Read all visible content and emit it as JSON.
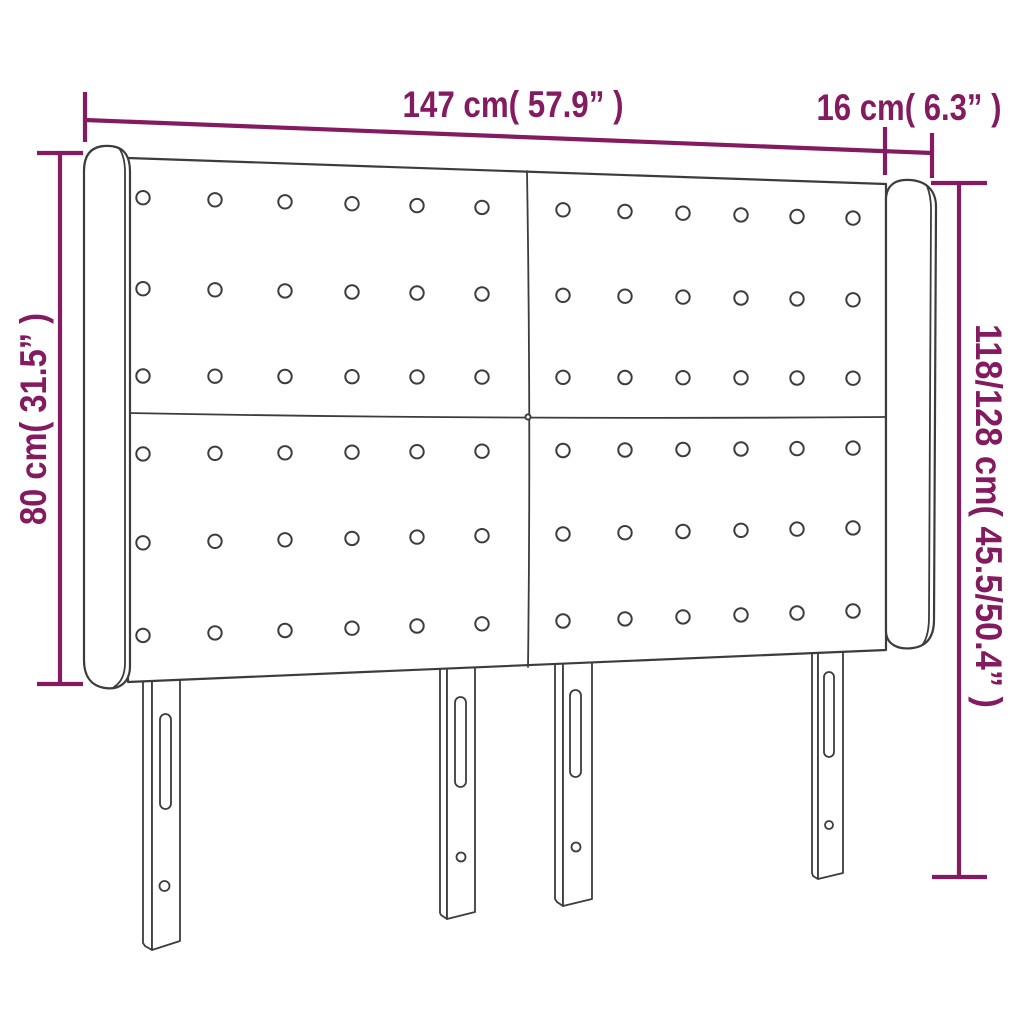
{
  "diagram": {
    "subject": "winged headboard with button tufting and four slotted legs",
    "dimensions": {
      "top_width": {
        "label": "147 cm( 57.9” )"
      },
      "ear_width": {
        "label": "16 cm( 6.3” )"
      },
      "left_height": {
        "label": "80 cm( 31.5” )"
      },
      "right_height": {
        "label": "118/128 cm( 45.5/50.4” )"
      }
    },
    "colors": {
      "dimension": "#841a60",
      "outline": "#3c3c3b",
      "background": "#ffffff"
    }
  }
}
